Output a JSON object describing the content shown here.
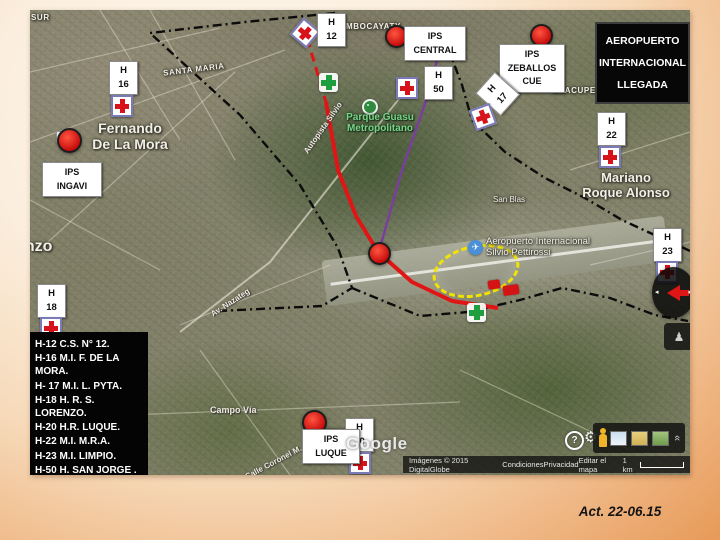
{
  "slide": {
    "date_note": "Act. 22-06.15"
  },
  "title_box": {
    "lines": [
      "AEROPUERTO",
      "INTERNACIONAL",
      "LLEGADA"
    ]
  },
  "legend": {
    "items": [
      "H-12 C.S. N° 12.",
      "H-16 M.I. F. DE LA MORA.",
      "H- 17 M.I. L. PYTA.",
      "H-18  H. R. S. LORENZO.",
      "H-20 H.R.  LUQUE.",
      "H-22 M.I. M.R.A.",
      "H-23 M.I. LIMPIO.",
      "H-50 H. SAN JORGE ."
    ]
  },
  "markers": {
    "h12": [
      "H",
      "12"
    ],
    "h16": [
      "H",
      "16"
    ],
    "h17": [
      "H",
      "17"
    ],
    "h18": [
      "H",
      "18"
    ],
    "h20": [
      "H",
      "20"
    ],
    "h22": [
      "H",
      "22"
    ],
    "h23": [
      "H",
      "23"
    ],
    "h50": [
      "H",
      "50"
    ],
    "ips_central": [
      "IPS",
      "CENTRAL"
    ],
    "ips_zeballos_cue": [
      "IPS",
      "ZEBALLOS",
      "CUE"
    ],
    "ips_ingavi": [
      "IPS",
      "INGAVI"
    ],
    "ips_luque": [
      "IPS",
      "LUQUE"
    ]
  },
  "map_labels": {
    "sur": "SUR",
    "santa_maria": "SANTA MARIA",
    "mbocayaty": "MBOCAYATY",
    "caacupemi": "CAACUPEMI",
    "fernando_de_la_mora": [
      "Fernando",
      "De La Mora"
    ],
    "mariano_roque_alonso": [
      "Mariano",
      "Roque Alonso"
    ],
    "san_blas": "San Blas",
    "san_lorenzo_partial": "enzo",
    "parque_guasu": [
      "Parque Guasu",
      "Metropolitano"
    ],
    "aeropuerto_silvio_pettirossi": [
      "Aeropuerto Internacional",
      "Silvio Pettirossi"
    ],
    "autopista": "Autopista Silvio",
    "av_nazateg": "Av. Nazateg",
    "campo_via": "Campo Vía",
    "calle_coronel": "Calle Coronel M.",
    "luque": "Luque",
    "ruta_shield": "3"
  },
  "watermark": {
    "google": "Google"
  },
  "attribution": {
    "imagery": "Imágenes © 2015 DigitalGlobe",
    "terms": "Condiciones",
    "privacy": "Privacidad",
    "edit": "Editar el mapa",
    "scale": "1 km"
  },
  "controls": {
    "help": "?"
  },
  "colors": {
    "marker_red": "#e01515",
    "cross_red": "#d8121a",
    "cross_frame": "#7a7ab8",
    "green_cross": "#1e9e3e",
    "route_red": "#e01515",
    "route_purple": "#7a3f9d",
    "highlight_yellow": "#f2e400",
    "boundary_black": "#0c0c0c",
    "pegman_yellow": "#f0b428"
  }
}
